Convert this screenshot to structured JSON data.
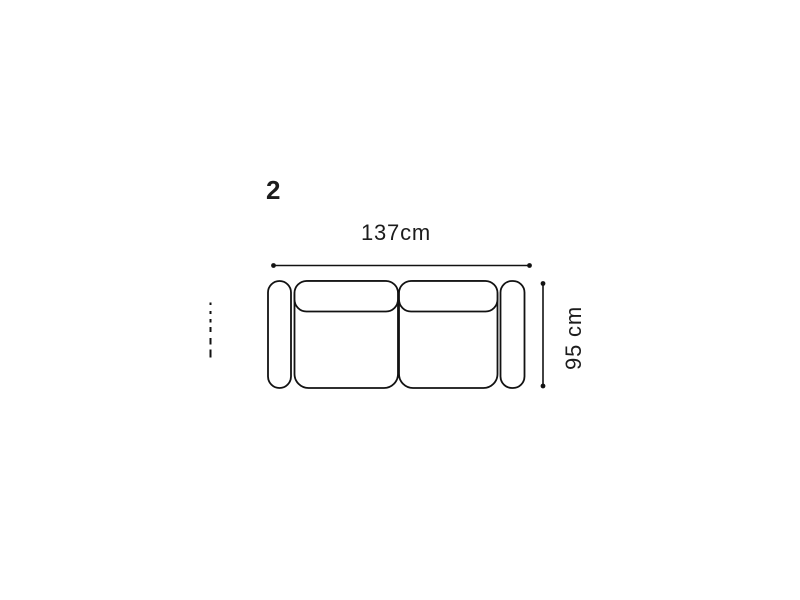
{
  "canvas": {
    "background": "#ffffff"
  },
  "diagram": {
    "type": "sofa-top-view-dimension-drawing",
    "item_label": "2",
    "width_label": "137cm",
    "height_label": "95 cm",
    "width_value_cm": 137,
    "height_value_cm": 95,
    "line_color": "#121212",
    "text_color": "#1c1c1c",
    "parts": [
      "left-armrest",
      "seat-left",
      "seat-right",
      "back-cushion-left",
      "back-cushion-right",
      "right-armrest"
    ]
  }
}
